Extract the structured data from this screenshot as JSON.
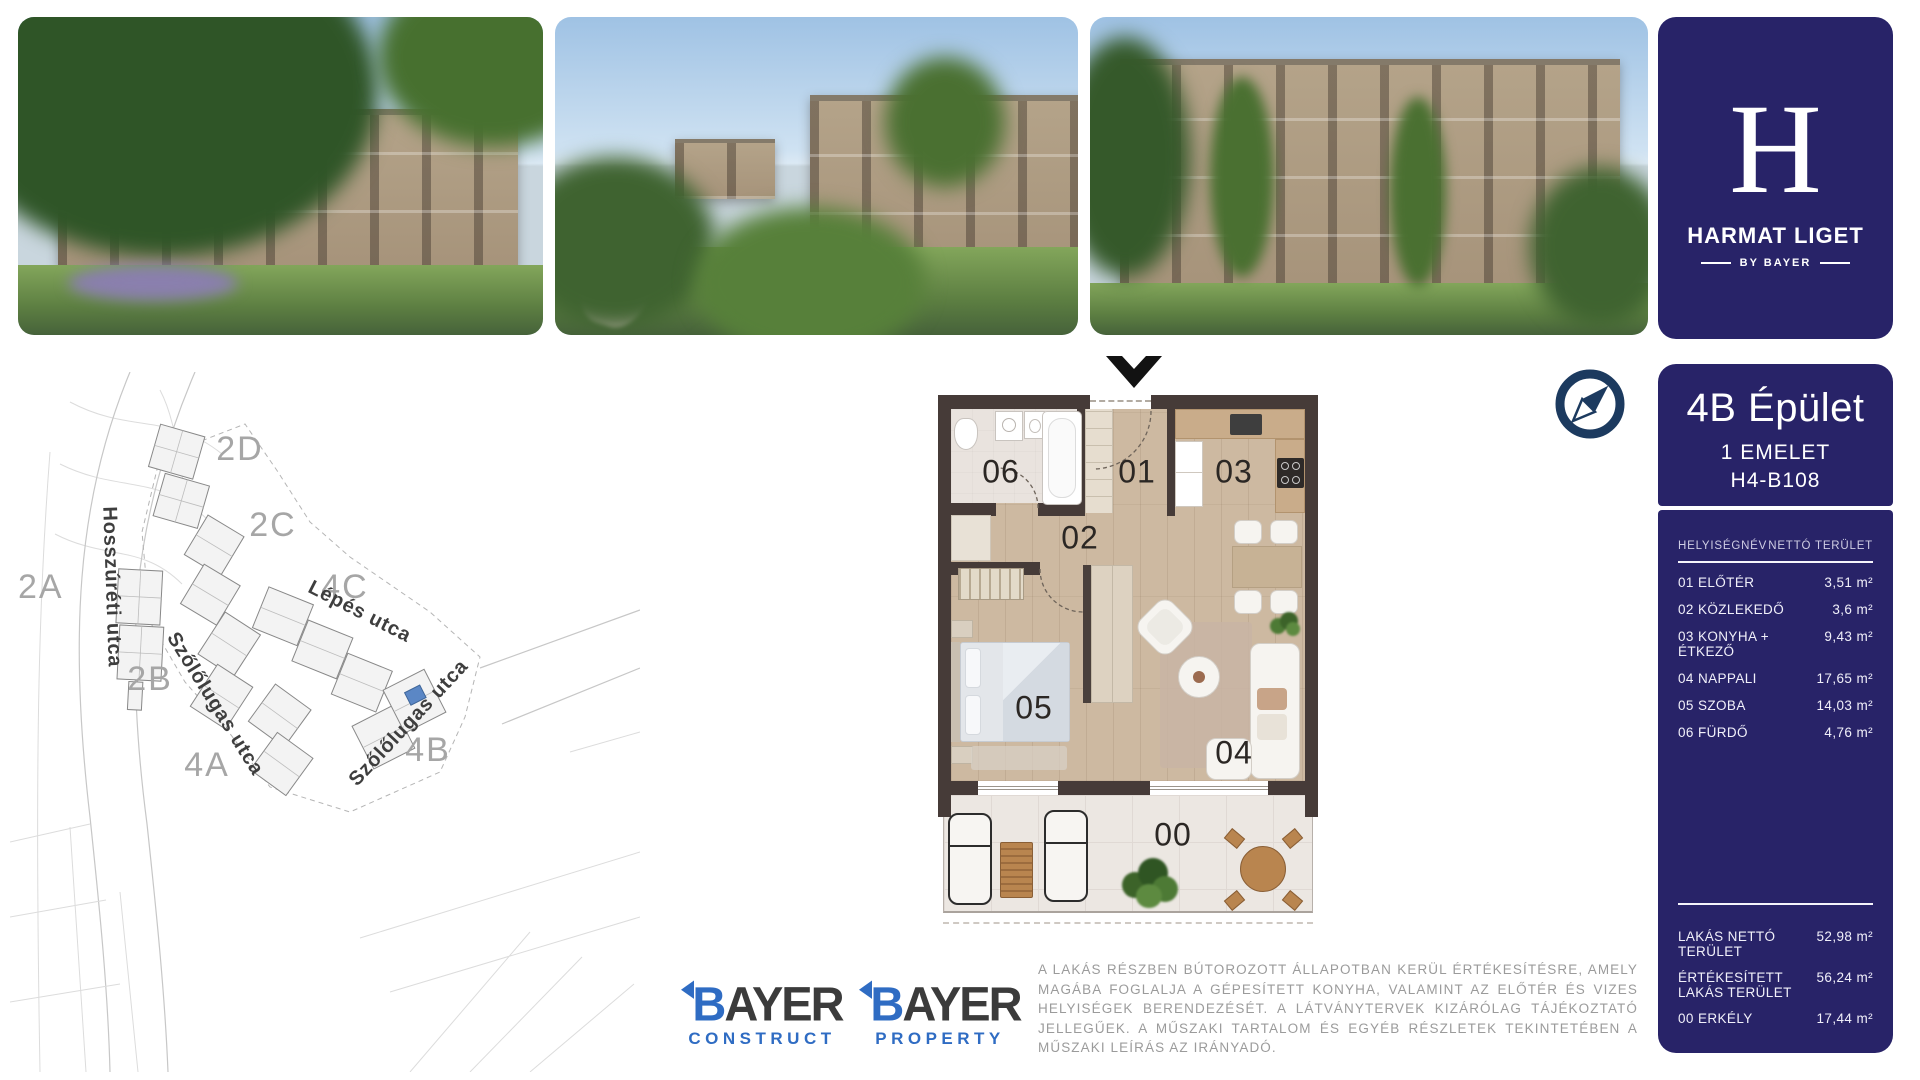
{
  "brand": {
    "letter": "H",
    "title": "HARMAT LIGET",
    "by": "BY BAYER"
  },
  "colors": {
    "navy": "#282368",
    "compass_navy": "#1c3a5f",
    "bayer_blue": "#2f6cc3",
    "map_highlight": "#5b87c5"
  },
  "photos": [
    {
      "name": "exterior-render-1"
    },
    {
      "name": "exterior-render-2"
    },
    {
      "name": "exterior-render-3"
    }
  ],
  "site_map": {
    "zones": [
      "2D",
      "2C",
      "2A",
      "4C",
      "2B",
      "4A",
      "4B"
    ],
    "streets": [
      "Hosszúréti utca",
      "Lépés utca",
      "Szőlőlugas utca",
      "Szőlőlugas utca"
    ]
  },
  "floor_plan": {
    "rooms": {
      "balcony": "00",
      "entry": "01",
      "hallway": "02",
      "kitchen": "03",
      "living": "04",
      "bedroom": "05",
      "bathroom": "06"
    }
  },
  "unit_panel": {
    "building": "4B Épület",
    "floor": "1 EMELET",
    "code": "H4-B108",
    "col_name": "HELYISÉGNÉV",
    "col_area": "NETTÓ TERÜLET",
    "rows": [
      {
        "name": "01 ELŐTÉR",
        "area": "3,51 m²"
      },
      {
        "name": "02 KÖZLEKEDŐ",
        "area": "3,6 m²"
      },
      {
        "name": "03 KONYHA + ÉTKEZŐ",
        "area": "9,43 m²"
      },
      {
        "name": "04 NAPPALI",
        "area": "17,65 m²"
      },
      {
        "name": "05 SZOBA",
        "area": "14,03 m²"
      },
      {
        "name": "06 FÜRDŐ",
        "area": "4,76 m²"
      }
    ],
    "summary": [
      {
        "name": "LAKÁS NETTÓ TERÜLET",
        "area": "52,98 m²"
      },
      {
        "name": "ÉRTÉKESÍTETT LAKÁS TERÜLET",
        "area": "56,24 m²"
      },
      {
        "name": "00 ERKÉLY",
        "area": "17,44 m²"
      }
    ]
  },
  "footer": {
    "logos": [
      {
        "b": "B",
        "rest": "AYER",
        "sub": "CONSTRUCT"
      },
      {
        "b": "B",
        "rest": "AYER",
        "sub": "PROPERTY"
      }
    ],
    "disclaimer": "A LAKÁS RÉSZBEN BÚTOROZOTT ÁLLAPOTBAN KERÜL ÉRTÉKESÍTÉSRE, AMELY MAGÁBA FOGLALJA A GÉPESÍTETT KONYHA, VALAMINT AZ ELŐTÉR ÉS VIZES HELYISÉGEK BERENDEZÉSÉT. A LÁTVÁNYTERVEK KIZÁRÓLAG TÁJÉKOZTATÓ JELLEGŰEK. A MŰSZAKI TARTALOM ÉS EGYÉB RÉSZLETEK TEKINTETÉBEN A MŰSZAKI LEÍRÁS AZ IRÁNYADÓ."
  }
}
